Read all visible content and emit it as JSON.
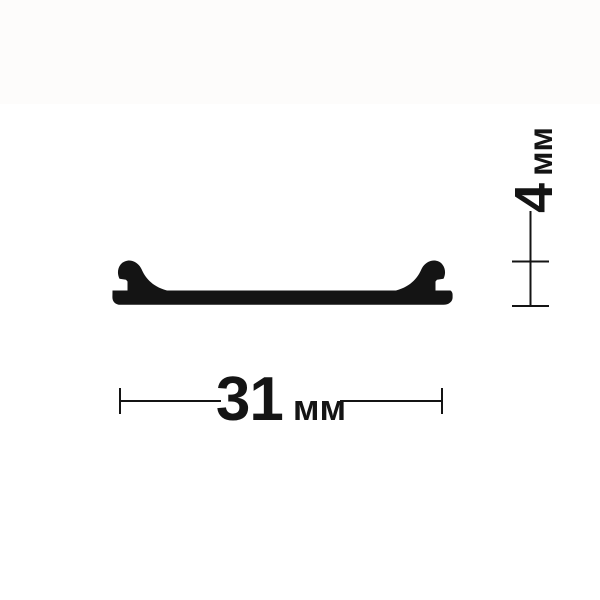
{
  "page": {
    "background_color": "#ffffff",
    "top_band_color": "#fdfcfb",
    "ink_color": "#141414"
  },
  "diagram": {
    "type": "technical-drawing",
    "subject": "profile-cross-section",
    "profile": {
      "path": "M 112.5 290.5 L 127.5 290.5 L 127.5 281.5 L 126 279.8 L 119.5 278.8 C 117.3 274.5 117.2 268.5 120.8 264.2 C 123.6 260.9 128.2 259.9 132 260.9 C 136 262 139.6 265 141.6 269.3 C 144.6 276.3 151.2 286.5 167 290.5 L 396 290.5 C 411.8 286.5 418.4 276.3 421.4 269.3 C 423.4 265 427 262 431 260.9 C 434.8 259.9 439.4 260.9 442.2 264.2 C 445.8 268.5 445.7 274.5 443.5 278.8 L 437 279.8 L 435.5 281.5 L 435.5 290.5 L 450.5 290.5 C 451.8 291.3 452.6 292.8 452.6 294.8 L 452.6 297.5 C 452.6 301.6 448.8 304.8 443.5 304.8 L 120.5 304.8 C 115.6 304.8 112.4 301.8 112.4 297.2 Z"
    },
    "width_dimension": {
      "value": "31",
      "unit": "мм",
      "label": "31 мм"
    },
    "height_dimension": {
      "value": "4",
      "unit": "мм",
      "label": "4 мм"
    }
  }
}
